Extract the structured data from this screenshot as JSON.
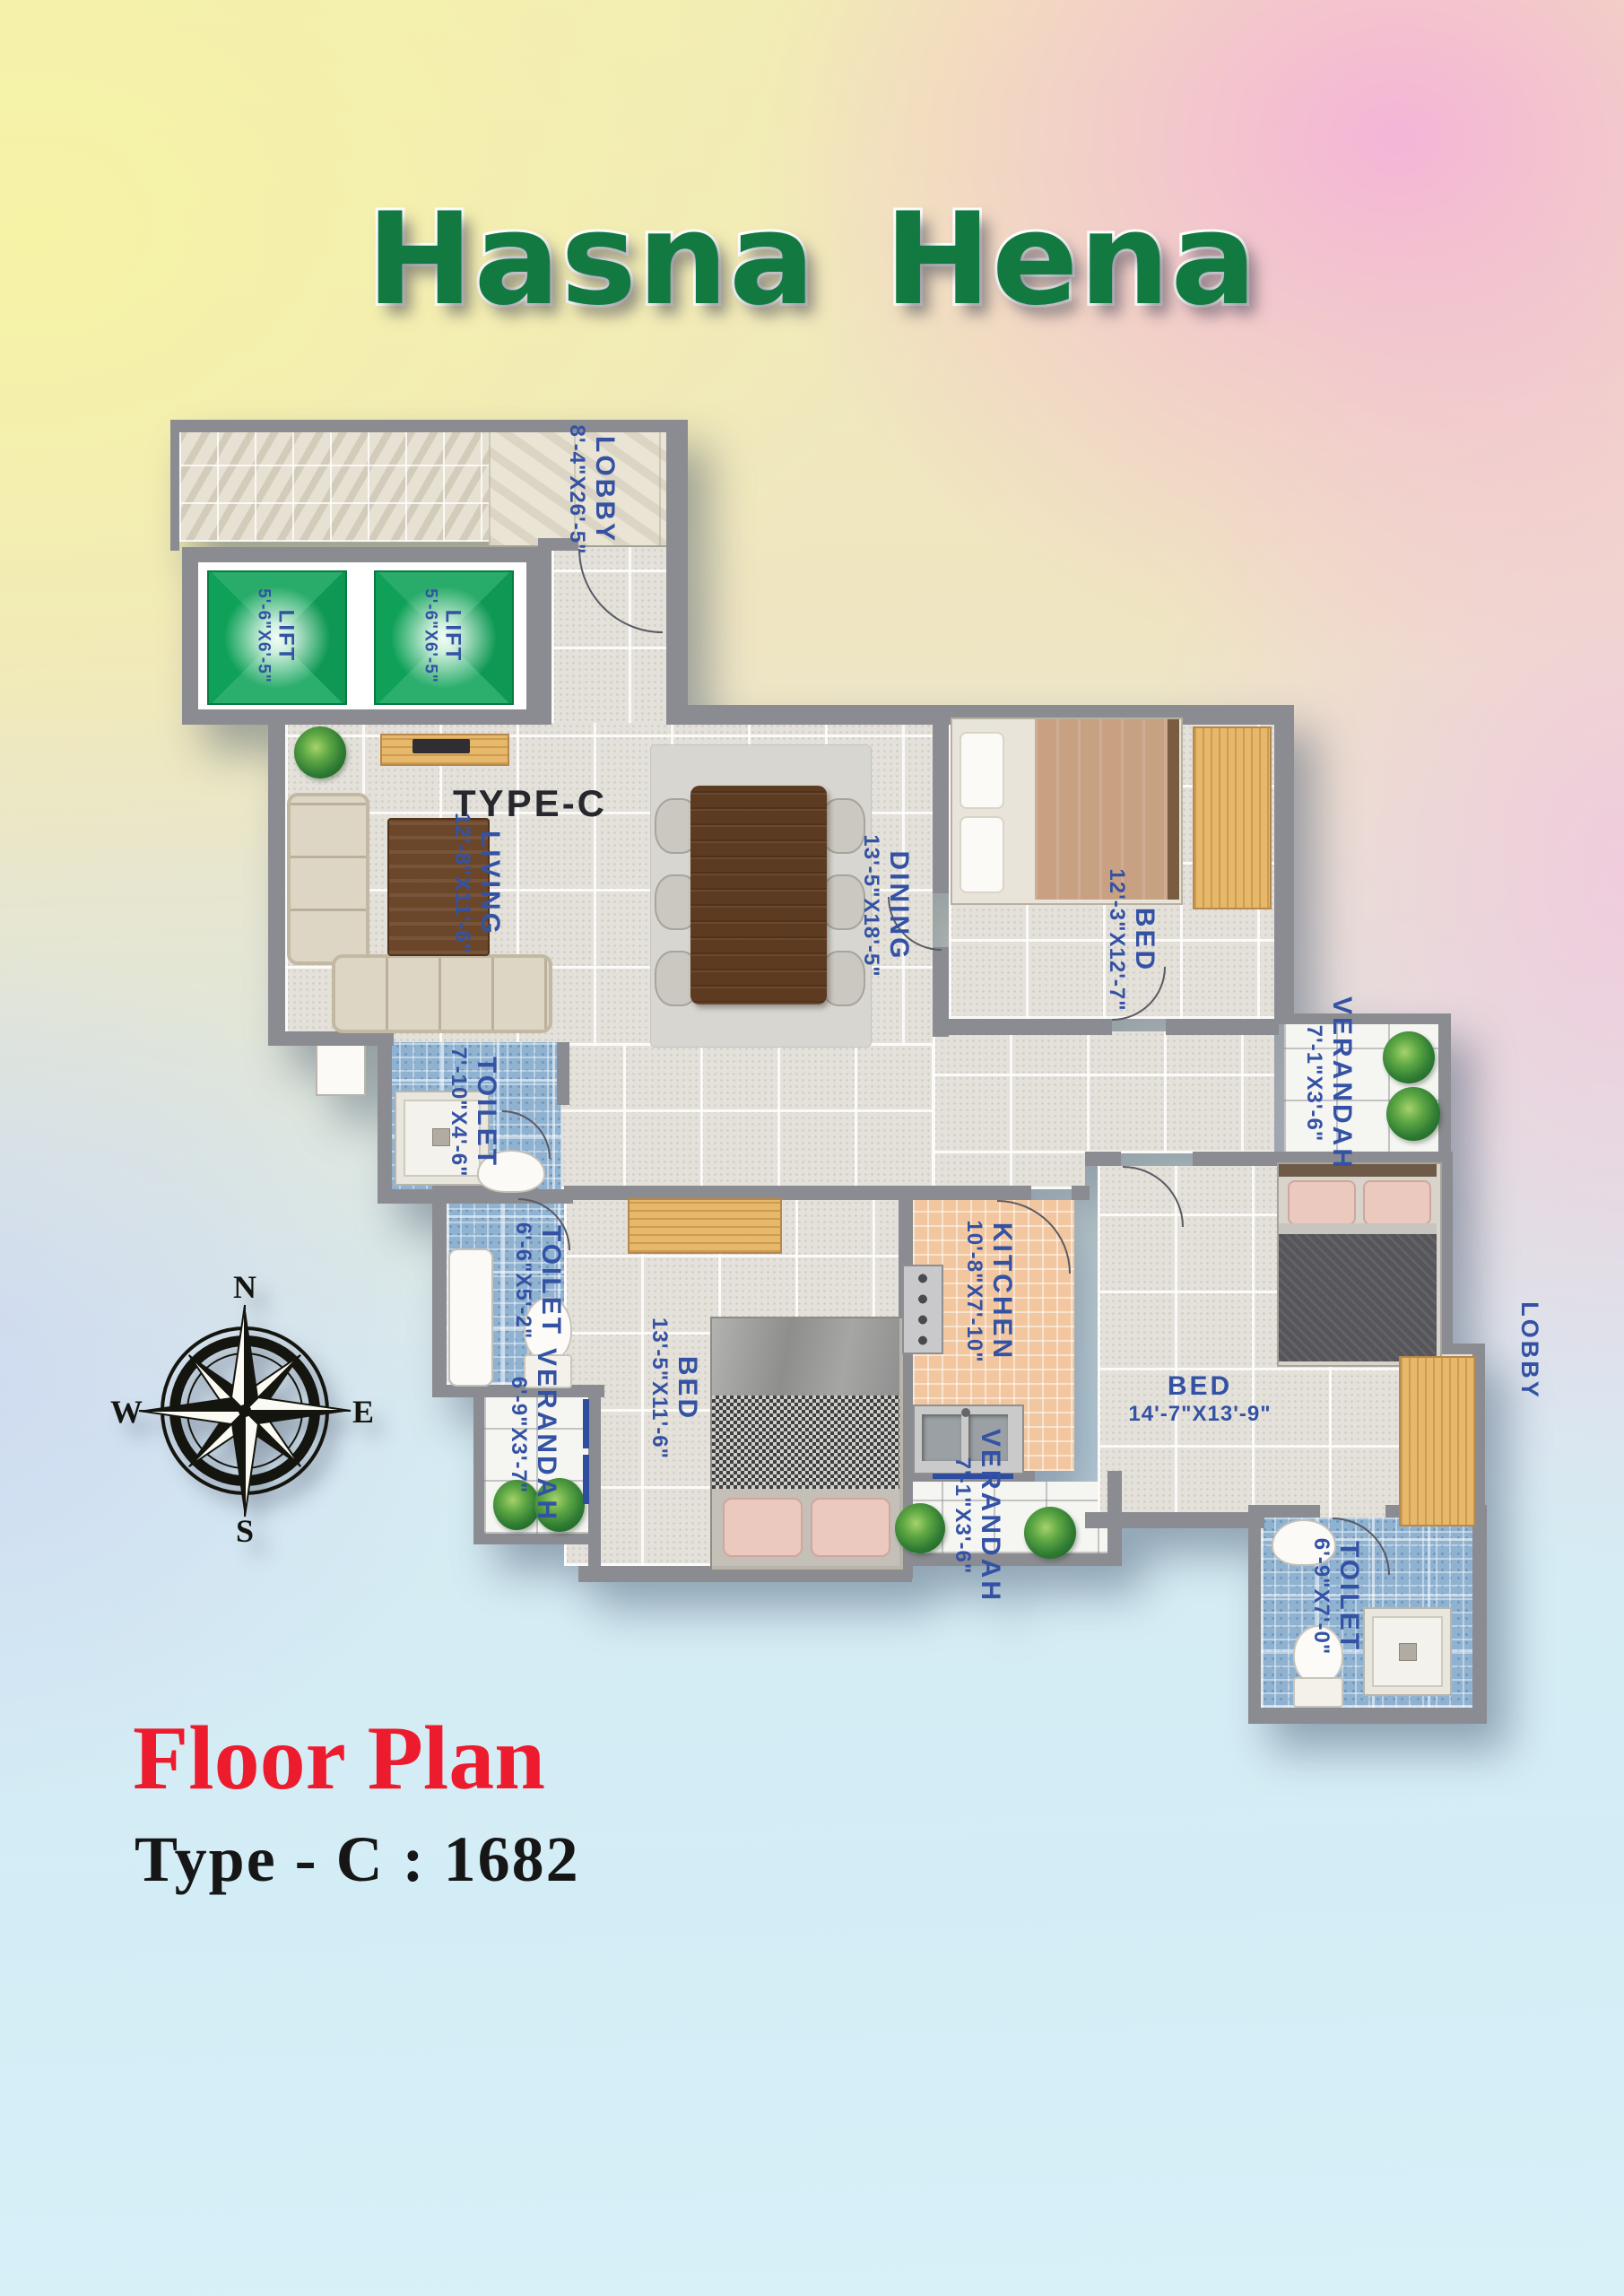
{
  "title": "Hasna Hena",
  "plan": {
    "type_label": "TYPE-C",
    "rooms": {
      "lobby_top": {
        "name": "LOBBY",
        "dim": "8'-4\"X26'-5\""
      },
      "lift_left": {
        "name": "LIFT",
        "dim": "5'-6\"X6'-5\""
      },
      "lift_right": {
        "name": "LIFT",
        "dim": "5'-6\"X6'-5\""
      },
      "living": {
        "name": "LIVING",
        "dim": "12'-8\"X11'-6\""
      },
      "dining": {
        "name": "DINING",
        "dim": "13'-5\"X18'-5\""
      },
      "bed_top_right": {
        "name": "BED",
        "dim": "12'-3\"X12'-7\""
      },
      "verandah_right": {
        "name": "VERANDAH",
        "dim": "7'-1\"X3'-6\""
      },
      "toilet_living": {
        "name": "TOILET",
        "dim": "7'-10\"X4'-6\""
      },
      "toilet_mid": {
        "name": "TOILET",
        "dim": "6'-6\"X5'-2\""
      },
      "bed_bottom_left": {
        "name": "BED",
        "dim": "13'-5\"X11'-6\""
      },
      "verandah_bottom_left": {
        "name": "VERANDAH",
        "dim": "6'-9\"X3'-7\""
      },
      "kitchen": {
        "name": "KITCHEN",
        "dim": "10'-8\"X7'-10\""
      },
      "verandah_bottom_mid": {
        "name": "VERANDAH",
        "dim": "7'-1\"X3'-6\""
      },
      "bed_right": {
        "name": "BED",
        "dim": "14'-7\"X13'-9\""
      },
      "toilet_bottom_right": {
        "name": "TOILET",
        "dim": "6'-9\"X7'-0\""
      },
      "lobby_right": {
        "name": "LOBBY"
      }
    },
    "compass": {
      "north": "N",
      "east": "E",
      "south": "S",
      "west": "W"
    }
  },
  "footer": {
    "heading": "Floor Plan",
    "subheading": "Type - C : 1682"
  },
  "colors": {
    "title_green": "#127a40",
    "heading_red": "#ec1c2e",
    "label_blue": "#3452a4",
    "lift_green": "#0fa158",
    "toilet_tile_blue": "#8fb2d1",
    "kitchen_tile_peach": "#f2c79f",
    "wall_grey": "#8b8b92"
  }
}
